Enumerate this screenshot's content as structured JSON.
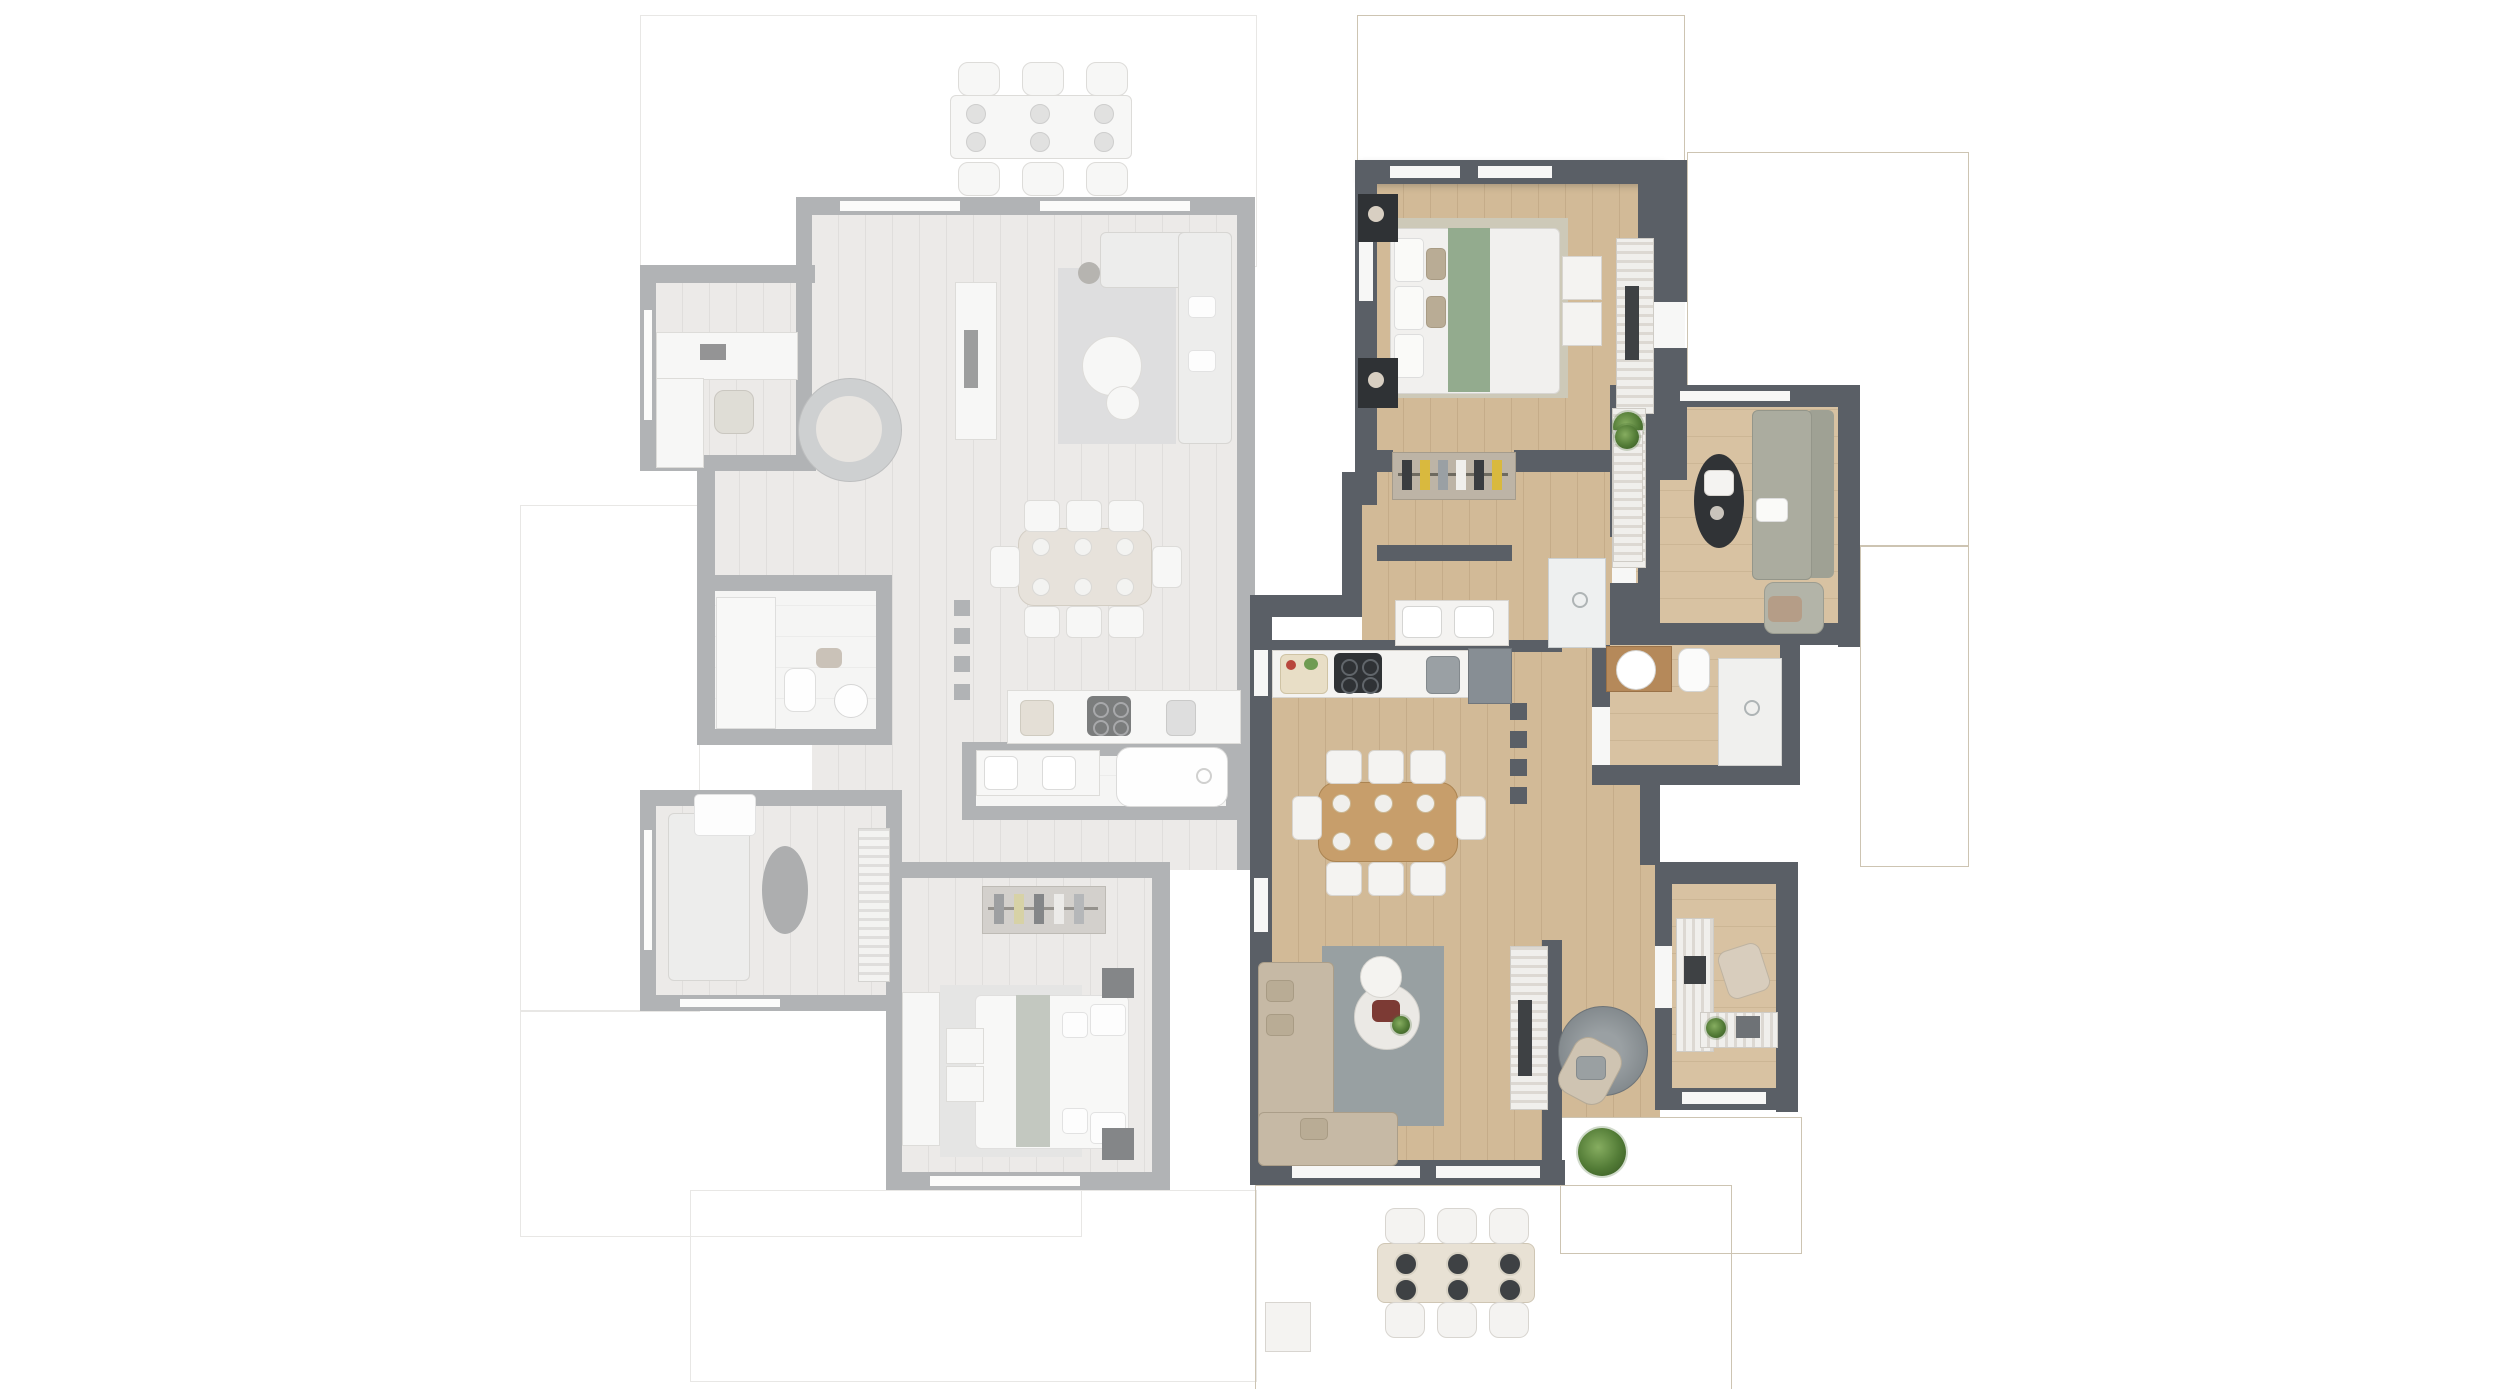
{
  "meta": {
    "type": "residential floor plan, top-down 3D render",
    "units_count": 2,
    "left_unit_state": "inactive (faded gray)",
    "right_unit_state": "active (highlighted)"
  },
  "colors": {
    "bg": "#ffffff",
    "wall-dark": "#5a5f66",
    "wall-light": "#a6aaaf",
    "lining": "#f7f7f6",
    "floor-wood": "#d2ba97",
    "floor-wood2": "#d8c2a2",
    "floor-light": "#e9e5df",
    "tile-beige": "#d8d0bf",
    "tile-beige-line": "#cbc2b0",
    "tile-light": "#f1f0ed",
    "tile-light-line": "#e3e1dc",
    "furn-white": "#f4f3f1",
    "accent-dark": "#3e4144",
    "sofa-beige": "#c6b9a5",
    "sofa-sage": "#abac9f",
    "bed-runner-green": "#93ab8e",
    "dining-wood": "#c79e6b",
    "rug-gray": "#98a0a2",
    "bath-counter-wood": "#b5895a"
  },
  "units": {
    "left": {
      "label": "Unit A (adjacent, faded)",
      "rooms": [
        "top terrace",
        "home office",
        "living room",
        "dining area",
        "kitchen",
        "bathroom with shower",
        "bathroom with bathtub",
        "second lounge",
        "bedroom",
        "side terrace",
        "bottom terrace"
      ],
      "furniture": [
        "outdoor dining table with 6 chairs",
        "L-shaped desk with chair",
        "papasan chair",
        "L-shaped sofa",
        "round coffee tables",
        "TV sideboard",
        "oval dining table with 8 chairs",
        "kitchen counter with cooktop and sink",
        "shower",
        "toilet",
        "round basin",
        "double vanity",
        "bathtub",
        "two-seat sofa",
        "oval coffee table",
        "wardrobe",
        "double bed with green runner",
        "nightstands",
        "dresser",
        "open closet with clothes",
        "potted plant"
      ]
    },
    "right": {
      "label": "Unit B (featured)",
      "rooms": [
        "top terrace",
        "master bedroom",
        "entry hall",
        "walk-in closet",
        "shower room",
        "second bedroom / TV lounge",
        "bathroom",
        "kitchen",
        "dining area",
        "living room",
        "home office",
        "hall corridor",
        "right terrace",
        "bottom terrace"
      ],
      "furniture": [
        "double bed with green runner",
        "black nightstands with lamps",
        "bed bench",
        "TV console",
        "open wardrobe with clothes",
        "double vanity",
        "walk-in shower",
        "sage green sofa with ottoman",
        "black oval coffee table",
        "sideboard with plant",
        "wood bathroom counter with round basin",
        "toilet",
        "kitchen counter with cooktop and sink",
        "tall kitchen cabinet",
        "rectangular wood dining table with 8 chairs",
        "beige L-shaped sofa",
        "round marble coffee tables",
        "TV media wall",
        "woven pouf",
        "reading armchair",
        "L-shaped desk with laptop and chair",
        "console table with plant",
        "outdoor dining table with 6 chairs",
        "storage box",
        "potted plants"
      ]
    },
    "legend_note": "no text labels are rendered in the image"
  },
  "counts": {
    "left_outdoor_seats": 6,
    "left_dining_seats": 8,
    "right_dining_seats": 8,
    "right_outdoor_seats": 6,
    "hall_wall_stub_columns_each_unit": 4
  }
}
